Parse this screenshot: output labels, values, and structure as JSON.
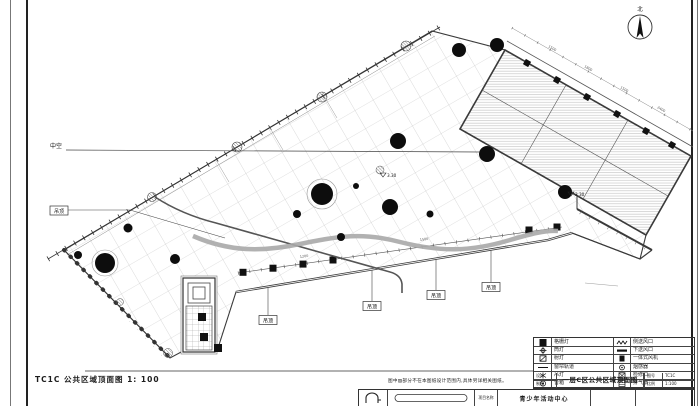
{
  "sheet": {
    "caption": "TC1C 公共区域顶面图 1: 100",
    "north": "北",
    "note": "图中▨部分不在本图纸设计范围内,具体另详相关图纸。"
  },
  "colors": {
    "line": "#2a2a2a",
    "grid": "#c2c2c2",
    "hatch": "#c9c9c9",
    "band": "#a8a8a8"
  },
  "annotations": {
    "void": "中空",
    "tag": "吊顶",
    "bottom_tags": [
      "吊顶",
      "吊顶",
      "吊顶",
      "吊顶"
    ],
    "levels": [
      "3.30",
      "3.30"
    ],
    "dims": [
      "1500",
      "1800",
      "1500",
      "2400",
      "1200",
      "1500"
    ]
  },
  "legend": {
    "left": [
      {
        "symbol": "grille-light",
        "label": "格栅灯"
      },
      {
        "symbol": "downlight",
        "label": "筒灯"
      },
      {
        "symbol": "spotlight",
        "label": "射灯"
      },
      {
        "symbol": "curtain-track",
        "label": "窗帘轨道"
      },
      {
        "symbol": "pendant-light",
        "label": "吊灯"
      },
      {
        "symbol": "speaker",
        "label": "音箱"
      }
    ],
    "right": [
      {
        "symbol": "return-air-vent",
        "label": "侧送风口"
      },
      {
        "symbol": "down-supply-vent",
        "label": "下送风口"
      },
      {
        "symbol": "integrated-fan",
        "label": "一体式风机"
      },
      {
        "symbol": "smoke-detector",
        "label": "烟感器"
      },
      {
        "symbol": "access-panel",
        "label": "检修口"
      },
      {
        "symbol": "exhaust-fan",
        "label": "排气扇"
      }
    ]
  },
  "title_block": {
    "left_rows": [
      "设计",
      "制图"
    ],
    "drawing_title": "一层C区公共区域顶面图",
    "no_label": "图号",
    "no_value": "TC1C",
    "scale_label": "比例",
    "scale_value": "1:100",
    "project_label": "项目名称",
    "project_name": "青少年活动中心"
  }
}
